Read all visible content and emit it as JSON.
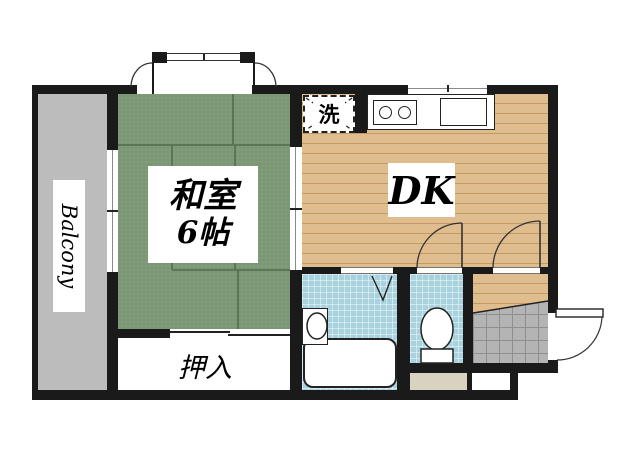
{
  "title": "Japanese apartment floor plan (1DK)",
  "labels": {
    "balcony": "Balcony",
    "washitsu_line1": "和室",
    "washitsu_line2": "6帖",
    "dk": "DK",
    "oshiire": "押入",
    "laundry": "洗"
  },
  "rooms": [
    {
      "name": "balcony",
      "label": "Balcony"
    },
    {
      "name": "japanese-room",
      "label": "和室 6帖"
    },
    {
      "name": "dining-kitchen",
      "label": "DK"
    },
    {
      "name": "closet",
      "label": "押入"
    },
    {
      "name": "laundry-space",
      "label": "洗"
    },
    {
      "name": "bathroom",
      "label": ""
    },
    {
      "name": "toilet-room",
      "label": ""
    },
    {
      "name": "entrance-genkan",
      "label": ""
    }
  ],
  "colors": {
    "wall": "#1a1a1a",
    "tatami": "#7f9b78",
    "tatami_line": "#46603f",
    "wood": "#e0bd8f",
    "wood_line": "#c59a62",
    "balcony": "#bcbcbc",
    "water": "#a9d2df",
    "genkan": "#b4b4b4",
    "genkan_line": "#8f8f8f",
    "beige": "#d8d3c0"
  }
}
